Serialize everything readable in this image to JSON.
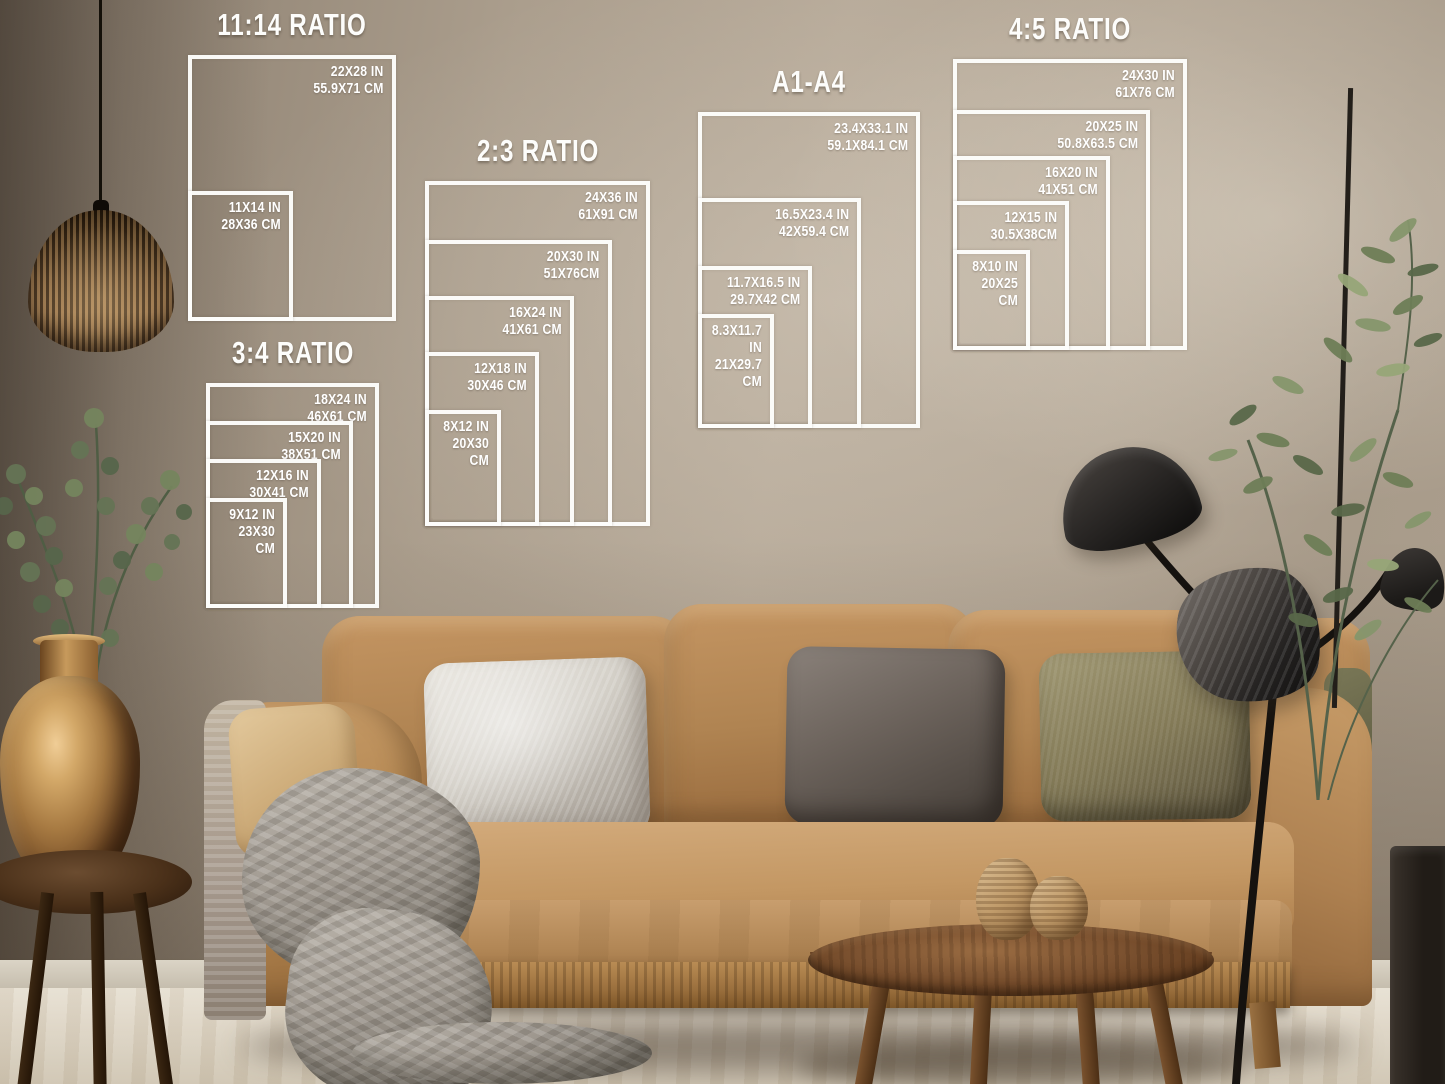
{
  "palette": {
    "overlay_white": "#fdfdfb",
    "wall": "#ab9e8d",
    "wall_dark": "#6f6456",
    "floor": "#ded5c6",
    "sofa": "#b2854f",
    "pillow_silver": "#d9d5cd",
    "pillow_charcoal": "#6b625b",
    "pillow_olive": "#837a57",
    "blanket": "#a19a91",
    "wood_table": "#653e20",
    "vase_bronze": "#a77a42",
    "lamp_black": "#1c1a18",
    "plant_green": "#6e7e57"
  },
  "size_groups": [
    {
      "id": "ratio-11-14",
      "title": "11:14 RATIO",
      "left": 188,
      "top": 55,
      "right": 396,
      "bottom": 321,
      "sizes": [
        {
          "inches": "22X28 IN",
          "cm": "55.9X71 CM",
          "top": 55,
          "right": 396
        },
        {
          "inches": "11X14 IN",
          "cm": "28X36 CM",
          "top": 191,
          "right": 293
        }
      ]
    },
    {
      "id": "ratio-2-3",
      "title": "2:3 RATIO",
      "left": 425,
      "top": 181,
      "right": 650,
      "bottom": 526,
      "sizes": [
        {
          "inches": "24X36 IN",
          "cm": "61X91 CM",
          "top": 181,
          "right": 650
        },
        {
          "inches": "20X30 IN",
          "cm": "51X76CM",
          "top": 240,
          "right": 612
        },
        {
          "inches": "16X24 IN",
          "cm": "41X61 CM",
          "top": 296,
          "right": 574
        },
        {
          "inches": "12X18 IN",
          "cm": "30X46 CM",
          "top": 352,
          "right": 539
        },
        {
          "inches": "8X12 IN",
          "cm": "20X30 CM",
          "top": 410,
          "right": 501
        }
      ]
    },
    {
      "id": "ratio-3-4",
      "title": "3:4 RATIO",
      "left": 206,
      "top": 383,
      "right": 379,
      "bottom": 608,
      "sizes": [
        {
          "inches": "18X24 IN",
          "cm": "46X61 CM",
          "top": 383,
          "right": 379
        },
        {
          "inches": "15X20 IN",
          "cm": "38X51 CM",
          "top": 421,
          "right": 353
        },
        {
          "inches": "12X16 IN",
          "cm": "30X41 CM",
          "top": 459,
          "right": 321
        },
        {
          "inches": "9X12 IN",
          "cm": "23X30 CM",
          "top": 498,
          "right": 287
        }
      ]
    },
    {
      "id": "a-series",
      "title": "A1-A4",
      "left": 698,
      "top": 112,
      "right": 920,
      "bottom": 428,
      "sizes": [
        {
          "inches": "23.4X33.1 IN",
          "cm": "59.1X84.1 CM",
          "top": 112,
          "right": 920
        },
        {
          "inches": "16.5X23.4 IN",
          "cm": "42X59.4 CM",
          "top": 198,
          "right": 861
        },
        {
          "inches": "11.7X16.5 IN",
          "cm": "29.7X42 CM",
          "top": 266,
          "right": 812
        },
        {
          "inches": "8.3X11.7 IN",
          "cm": "21X29.7 CM",
          "top": 314,
          "right": 774
        }
      ]
    },
    {
      "id": "ratio-4-5",
      "title": "4:5 RATIO",
      "left": 953,
      "top": 59,
      "right": 1187,
      "bottom": 350,
      "sizes": [
        {
          "inches": "24X30 IN",
          "cm": "61X76 CM",
          "top": 59,
          "right": 1187
        },
        {
          "inches": "20X25 IN",
          "cm": "50.8X63.5 CM",
          "top": 110,
          "right": 1150
        },
        {
          "inches": "16X20 IN",
          "cm": "41X51 CM",
          "top": 156,
          "right": 1110
        },
        {
          "inches": "12X15 IN",
          "cm": "30.5X38CM",
          "top": 201,
          "right": 1069
        },
        {
          "inches": "8X10 IN",
          "cm": "20X25 CM",
          "top": 250,
          "right": 1030
        }
      ]
    }
  ]
}
